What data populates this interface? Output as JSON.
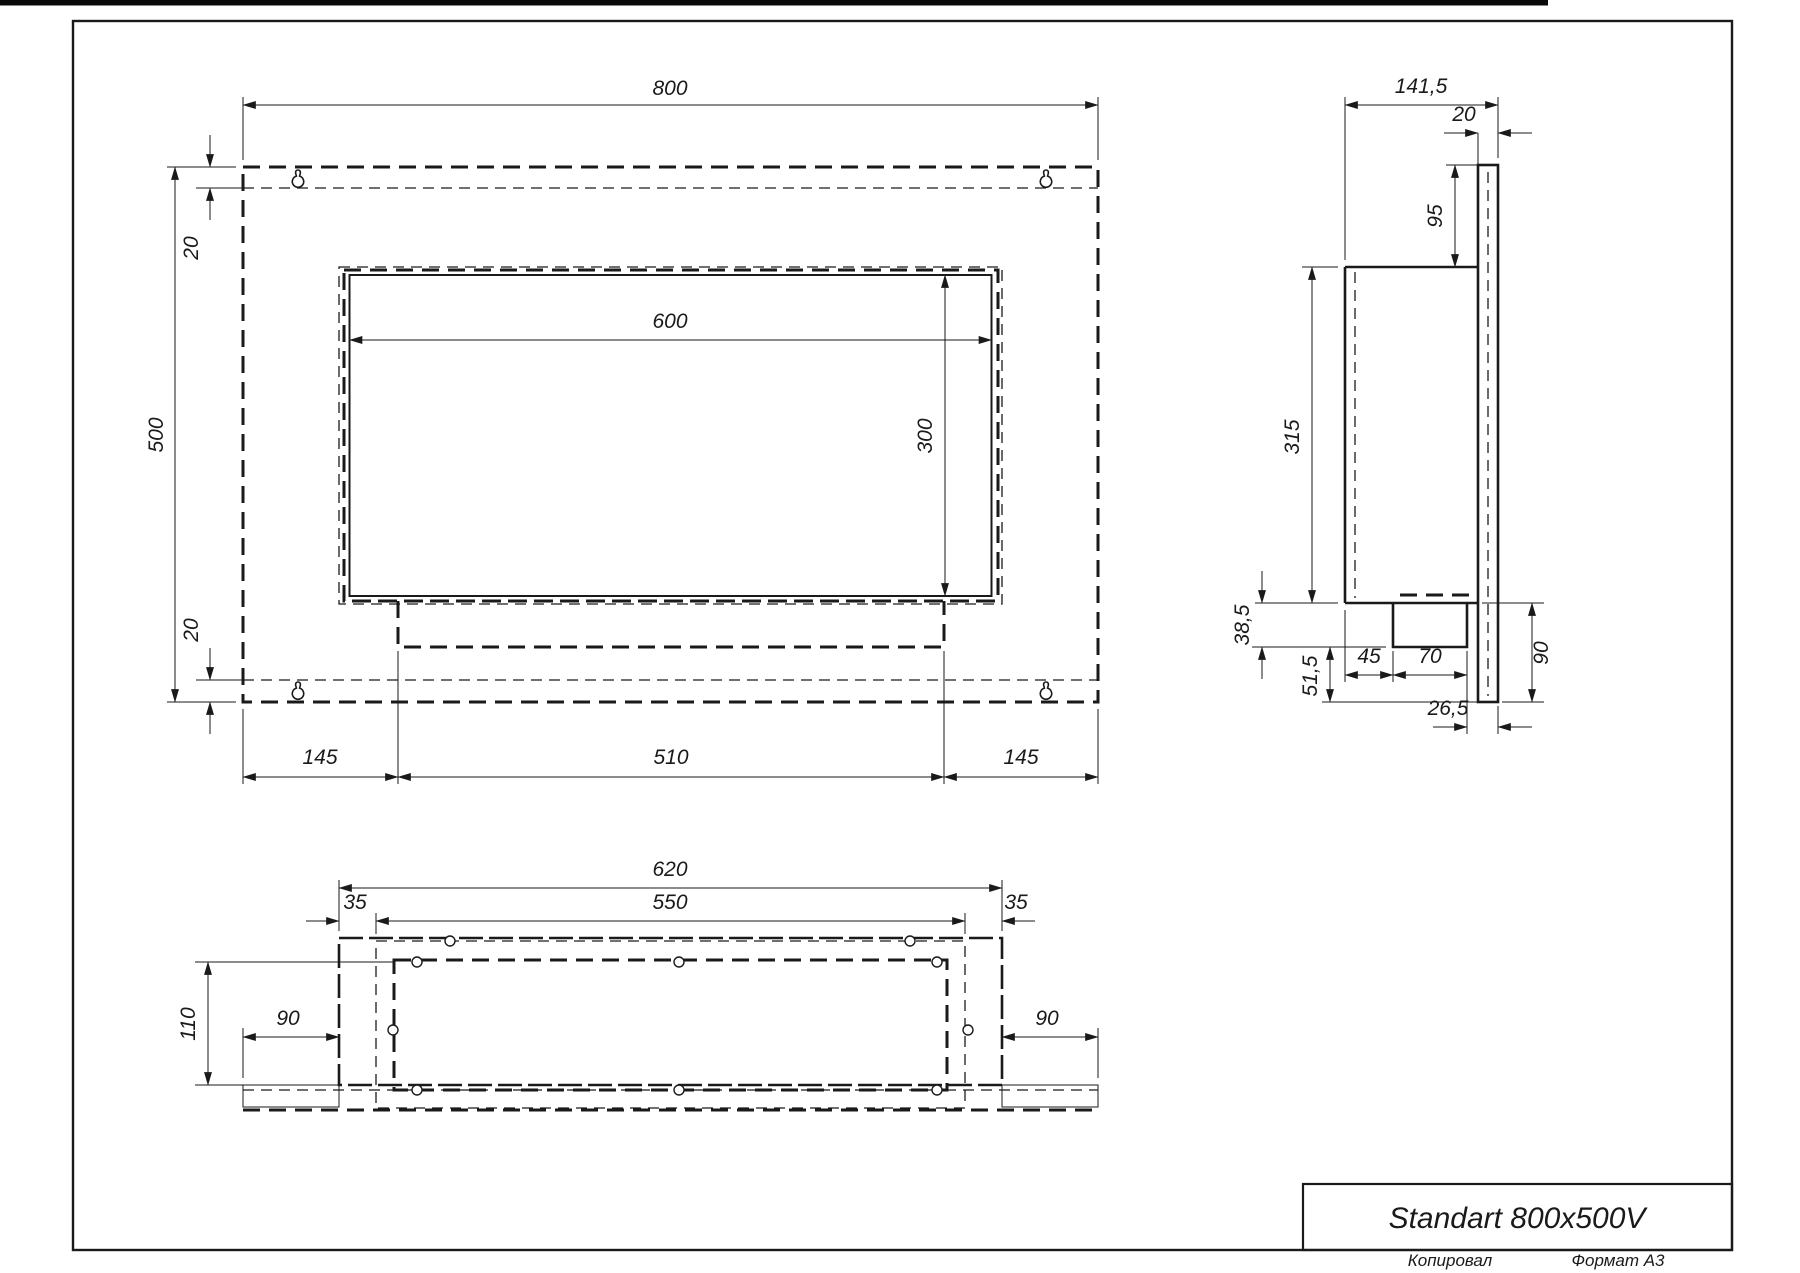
{
  "colors": {
    "ink": "#1a1a1a",
    "paper": "#ffffff"
  },
  "title_block": {
    "title": "Standart 800x500V",
    "copied": "Копировал",
    "format": "Формат А3"
  },
  "views": {
    "front": {
      "width": "800",
      "height": "500",
      "top_gap": "20",
      "bottom_gap": "20",
      "opening_width": "600",
      "opening_height": "300",
      "left_margin": "145",
      "tray_width": "510",
      "right_margin": "145"
    },
    "side": {
      "depth": "141,5",
      "plate_thickness": "20",
      "plate_top_to_box": "95",
      "box_height": "315",
      "tray_height": "38,5",
      "tray_to_plate_bottom": "51,5",
      "front_to_tray": "45",
      "tray_depth": "70",
      "tray_to_wall": "26,5",
      "plate_below_box": "90"
    },
    "bottom": {
      "box_width": "620",
      "insert_width": "550",
      "left_inset": "35",
      "right_inset": "35",
      "depth": "110",
      "left_wing": "90",
      "right_wing": "90"
    }
  }
}
